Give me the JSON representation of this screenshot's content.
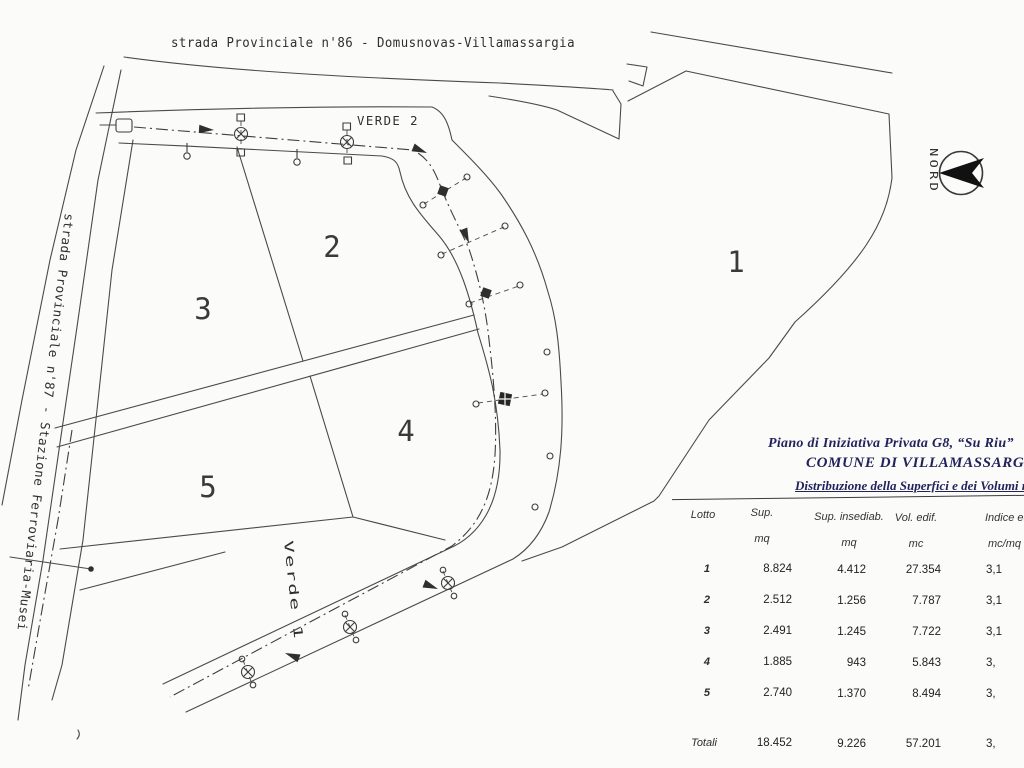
{
  "drawing": {
    "top_road_label": "strada Provinciale n'86 - Domusnovas-Villamassargia",
    "left_road_label": "strada Provinciale n'87 - Stazione Ferroviaria-Musei",
    "verde2_label": "VERDE 2",
    "verde1_label": "Verde 1",
    "north_label": "NORD",
    "lots": [
      "1",
      "2",
      "3",
      "4",
      "5"
    ]
  },
  "panel": {
    "title1": "Piano di Iniziativa Privata  G8, “Su Riu”",
    "title2": "COMUNE DI VILLAMASSARGIA",
    "subtitle": "Distribuzione della Superfici e dei Volumi nei lotti",
    "headers": {
      "lotto": "Lotto",
      "sup": "Sup.",
      "sup_unit": "mq",
      "ins": "Sup. insediab.",
      "ins_unit": "mq",
      "vol": "Vol. edif.",
      "vol_unit": "mc",
      "ind": "Indice ed",
      "ind_unit": "mc/mq"
    },
    "rows": [
      [
        "1",
        "8.824",
        "4.412",
        "27.354",
        "3,1"
      ],
      [
        "2",
        "2.512",
        "1.256",
        "7.787",
        "3,1"
      ],
      [
        "3",
        "2.491",
        "1.245",
        "7.722",
        "3,1"
      ],
      [
        "4",
        "1.885",
        "943",
        "5.843",
        "3,"
      ],
      [
        "5",
        "2.740",
        "1.370",
        "8.494",
        "3,"
      ]
    ],
    "total": [
      "Totali",
      "18.452",
      "9.226",
      "57.201",
      "3,"
    ]
  },
  "colors": {
    "ink": "#4a4a4a",
    "title_ink": "#23235c",
    "paper": "#fbfbf9"
  }
}
